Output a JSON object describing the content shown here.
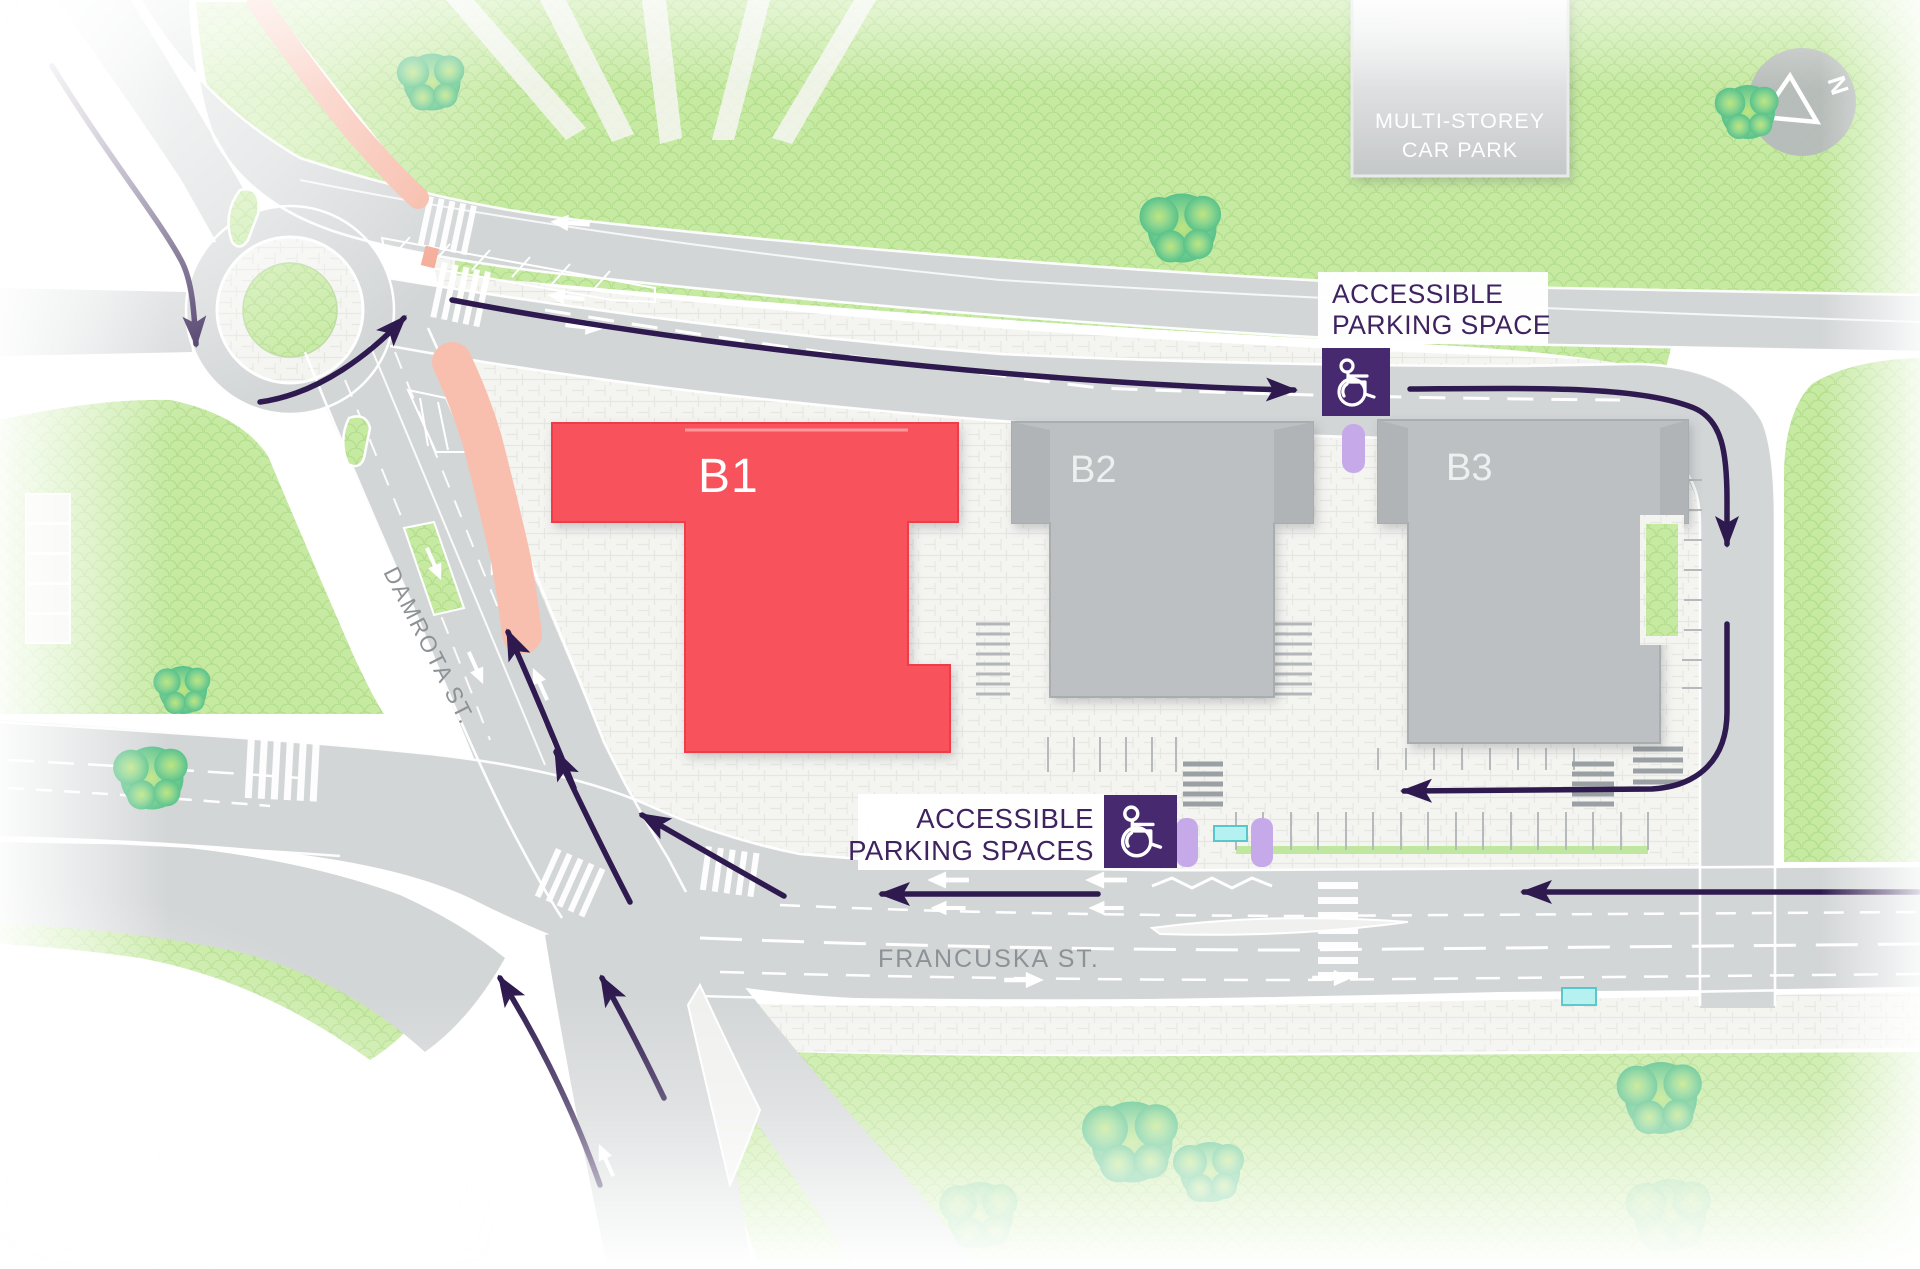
{
  "map": {
    "buildings": {
      "b1": {
        "label": "B1"
      },
      "b2": {
        "label": "B2"
      },
      "b3": {
        "label": "B3"
      },
      "car_park": {
        "line1": "MULTI-STOREY",
        "line2": "CAR PARK"
      }
    },
    "signs": {
      "space": {
        "line1": "ACCESSIBLE",
        "line2": "PARKING SPACE"
      },
      "spaces": {
        "line1": "ACCESSIBLE",
        "line2": "PARKING SPACES"
      }
    },
    "streets": {
      "damrota": "DAMROTA ST.",
      "francuska": "FRANCUSKA ST."
    },
    "compass": {
      "north": "N"
    },
    "colors": {
      "highlight_building": "#f8535b",
      "building_gray": "#bcc0c2",
      "accessible_purple": "#46296f",
      "accessible_space": "#c6a9e8",
      "route_arrow": "#2e1a4e",
      "road": "#d3d6d7",
      "grass": "#c7eaa3",
      "bus_shelter": "#b5f1f0"
    }
  }
}
